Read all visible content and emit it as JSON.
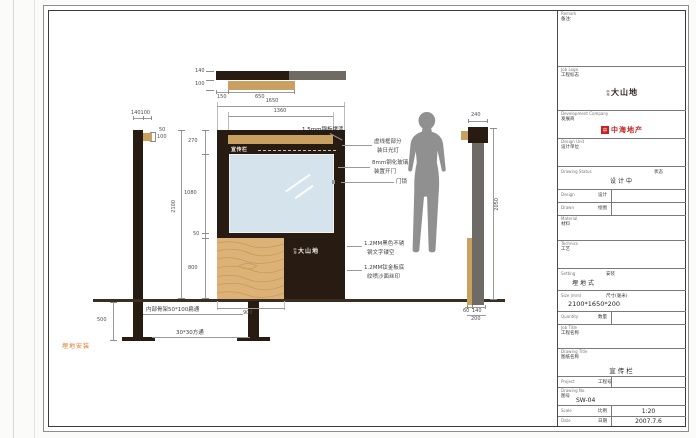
{
  "drawing": {
    "sign_label": "宣传栏",
    "sign_logo_prefix": "中海",
    "sign_logo": "大山地",
    "annotations": {
      "steel_plate": "1.5mm钢板烤漆",
      "light_1": "虚线框部分",
      "light_2": "装日光灯",
      "glass_1": "8mm钢化玻璃",
      "glass_2": "装置开门",
      "lock": "门锁",
      "steel_text_1": "1.2MM黑色不锈",
      "steel_text_2": "钢文字镂空",
      "ti_board_1": "1.2MM钛金板底",
      "ti_board_2": "纹喷沙面丝印",
      "frame_tube": "内部骨架50*100扁通",
      "square_tube": "30*30方通",
      "install": "埋地安装"
    },
    "dims": {
      "plan_h1": "140",
      "plan_h2": "100",
      "plan_w1": "150",
      "plan_w2": "650",
      "pole_top": "140100",
      "pole_b1": "50",
      "pole_b2": "100",
      "front_w": "1650",
      "front_w_inner": "1360",
      "front_h1": "270",
      "front_h2": "1080",
      "front_h3": "50",
      "front_h4": "800",
      "front_total": "2100",
      "wood_w": "900",
      "depth": "500",
      "side_cap": "240",
      "side_h": "2050",
      "side_b1": "60",
      "side_b2": "140",
      "side_b3": "200"
    }
  },
  "sheet": {
    "title_block": {
      "remark": {
        "en": "Remark",
        "cn": "备注:"
      },
      "job_logo": {
        "en": "Job Logo",
        "cn": "工程标志",
        "logo_prefix": "中海",
        "logo_text": "大山地"
      },
      "developer": {
        "en": "Development Company",
        "cn": "发展商",
        "logo_icon": "中",
        "logo_text": "中海地产"
      },
      "design_unit": {
        "en": "Design Unit",
        "cn": "设计单位"
      },
      "drawing_status": {
        "en": "Drawing Status",
        "cn": "状态",
        "value": "设计中"
      },
      "design": {
        "en": "Design",
        "cn": "设计",
        "value": ""
      },
      "drawn": {
        "en": "Drawn",
        "cn": "绘图",
        "value": ""
      },
      "material": {
        "en": "Material",
        "cn": "材料"
      },
      "technics": {
        "en": "Technics",
        "cn": "工艺"
      },
      "setting": {
        "en": "Setting",
        "cn": "安装",
        "value": "埋地式"
      },
      "size": {
        "en": "Size (mm)",
        "cn": "尺寸(毫米)",
        "value": "2100*1650*200"
      },
      "quantity": {
        "en": "Quantity",
        "cn": "数量",
        "value": ""
      },
      "job_title": {
        "en": "Job Title",
        "cn": "工程名称"
      },
      "drawing_title": {
        "en": "Drawing Title",
        "cn": "图纸名称",
        "value": "宣传栏"
      },
      "project": {
        "en": "Project",
        "cn": "工程号",
        "value": ""
      },
      "drawing_no": {
        "en": "Drawing No.",
        "cn": "图号",
        "value": "SW-04"
      },
      "scale": {
        "en": "Scale",
        "cn": "比例",
        "value": "1:20"
      },
      "date": {
        "en": "Date",
        "cn": "日期",
        "value": "2007.7.6"
      }
    }
  }
}
